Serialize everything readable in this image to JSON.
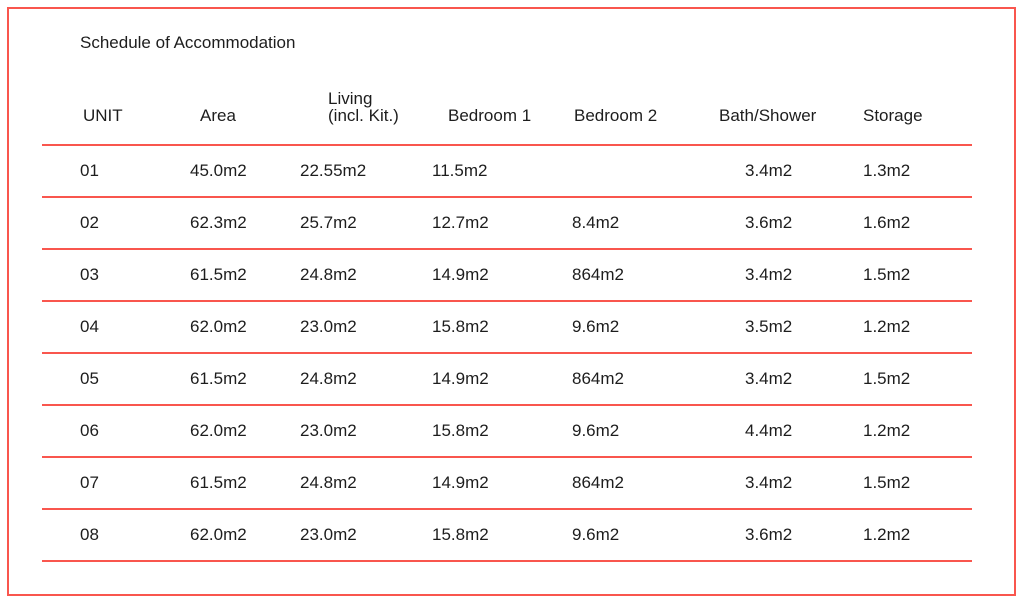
{
  "title": "Schedule of Accommodation",
  "colors": {
    "rule_line": "#f9564e",
    "border": "#f9564e",
    "text": "#1d1d1d",
    "background": "#ffffff"
  },
  "table": {
    "columns": [
      {
        "label": "UNIT"
      },
      {
        "label": "Area"
      },
      {
        "label": "Living",
        "label2": "(incl. Kit.)"
      },
      {
        "label": "Bedroom 1"
      },
      {
        "label": "Bedroom 2"
      },
      {
        "label": "Bath/Shower"
      },
      {
        "label": "Storage"
      }
    ],
    "rows": [
      {
        "unit": "01",
        "area": "45.0m2",
        "living": "22.55m2",
        "bedroom1": "11.5m2",
        "bedroom2": "",
        "bath_shower": "3.4m2",
        "storage": "1.3m2"
      },
      {
        "unit": "02",
        "area": "62.3m2",
        "living": "25.7m2",
        "bedroom1": "12.7m2",
        "bedroom2": "8.4m2",
        "bath_shower": "3.6m2",
        "storage": "1.6m2"
      },
      {
        "unit": "03",
        "area": "61.5m2",
        "living": "24.8m2",
        "bedroom1": "14.9m2",
        "bedroom2": "864m2",
        "bath_shower": "3.4m2",
        "storage": "1.5m2"
      },
      {
        "unit": "04",
        "area": "62.0m2",
        "living": "23.0m2",
        "bedroom1": "15.8m2",
        "bedroom2": "9.6m2",
        "bath_shower": "3.5m2",
        "storage": "1.2m2"
      },
      {
        "unit": "05",
        "area": "61.5m2",
        "living": "24.8m2",
        "bedroom1": "14.9m2",
        "bedroom2": "864m2",
        "bath_shower": "3.4m2",
        "storage": "1.5m2"
      },
      {
        "unit": "06",
        "area": "62.0m2",
        "living": "23.0m2",
        "bedroom1": "15.8m2",
        "bedroom2": "9.6m2",
        "bath_shower": "4.4m2",
        "storage": "1.2m2"
      },
      {
        "unit": "07",
        "area": "61.5m2",
        "living": "24.8m2",
        "bedroom1": "14.9m2",
        "bedroom2": "864m2",
        "bath_shower": "3.4m2",
        "storage": "1.5m2"
      },
      {
        "unit": "08",
        "area": "62.0m2",
        "living": "23.0m2",
        "bedroom1": "15.8m2",
        "bedroom2": "9.6m2",
        "bath_shower": "3.6m2",
        "storage": "1.2m2"
      }
    ]
  }
}
